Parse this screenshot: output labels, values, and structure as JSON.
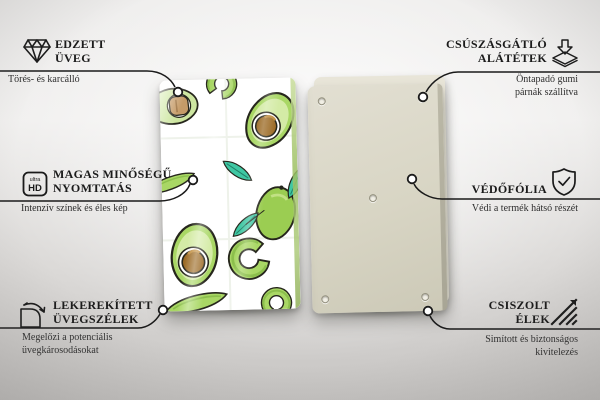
{
  "product": {
    "name": "avocado-pattern-glass-board",
    "front_panel": "glass panel with avocado illustration pattern",
    "back_panel": "plain beige backing panel with mounting holes",
    "colors": {
      "accent_line": "#1a1a1a",
      "avocado_skin_green": "#a9d765",
      "avocado_flesh_green": "#d4eba6",
      "avocado_dark_green": "#8cbf4c",
      "pit_brown": "#9c6b26",
      "pit_tan": "#c59b68",
      "leaf_teal": "#3fc7a3",
      "back_panel_beige": "#d7d4c3",
      "background_gray": "#c9c7c5"
    }
  },
  "callouts": {
    "top_left": {
      "icon": "diamond-icon",
      "title_lines": [
        "EDZETT",
        "ÜVEG"
      ],
      "subtitle_lines": [
        "Törés- és karcálló"
      ]
    },
    "middle_left": {
      "icon": "ultra-hd-icon",
      "icon_text_small": "ultra",
      "icon_text_big": "HD",
      "title_lines": [
        "MAGAS MINŐSÉGŰ",
        "NYOMTATÁS"
      ],
      "subtitle_lines": [
        "Intenzív színek és éles kép"
      ]
    },
    "bottom_left": {
      "icon": "rounded-corner-icon",
      "title_lines": [
        "LEKEREKÍTETT",
        "ÜVEGSZÉLEK"
      ],
      "subtitle_lines": [
        "Megelőzi a potenciális",
        "üvegkárosodásokat"
      ]
    },
    "top_right": {
      "icon": "anti-slip-pad-icon",
      "title_lines": [
        "CSÚSZÁSGÁTLÓ",
        "ALÁTÉTEK"
      ],
      "subtitle_lines": [
        "Öntapadó gumi",
        "párnák szállítva"
      ]
    },
    "middle_right": {
      "icon": "shield-check-icon",
      "title_lines": [
        "VÉDŐFÓLIA"
      ],
      "subtitle_lines": [
        "Védi a termék hátsó részét"
      ]
    },
    "bottom_right": {
      "icon": "polished-edge-icon",
      "title_lines": [
        "CSISZOLT",
        "ÉLEK"
      ],
      "subtitle_lines": [
        "Simított és biztonságos",
        "kivitelezés"
      ]
    }
  }
}
